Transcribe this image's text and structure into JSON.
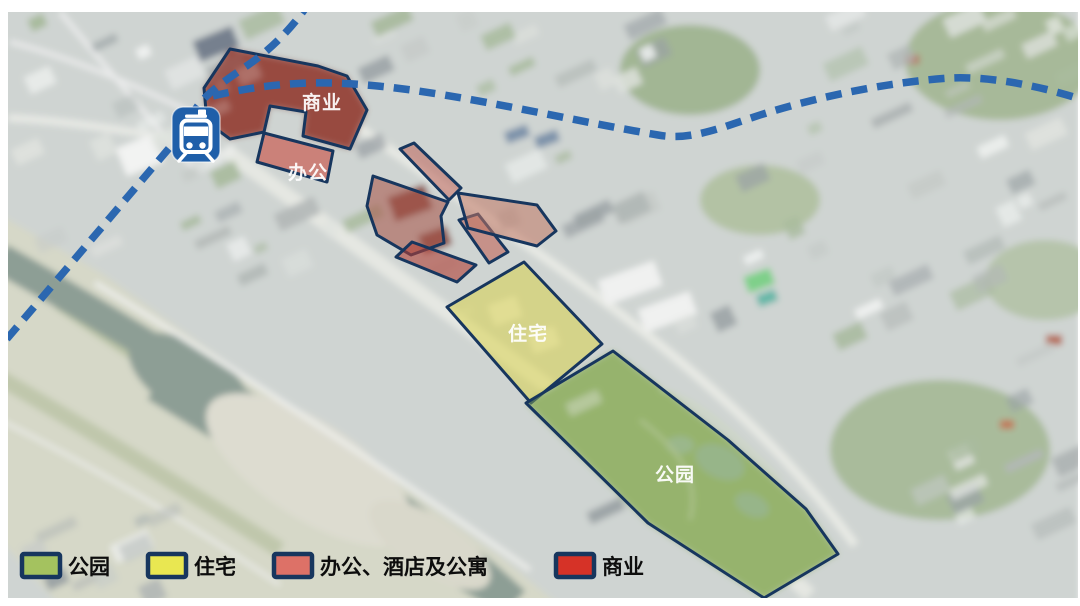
{
  "legend": {
    "swatch_border_color": "#17365e",
    "items": [
      {
        "id": "park",
        "label": "公园",
        "color": "#a4c25f"
      },
      {
        "id": "residential",
        "label": "住宅",
        "color": "#e9e751"
      },
      {
        "id": "office-hotel-apartment",
        "label": "办公、酒店及公寓",
        "color": "#dd7167"
      },
      {
        "id": "commercial",
        "label": "商业",
        "color": "#d63227"
      }
    ]
  },
  "map": {
    "zone_labels": {
      "commercial": "商业",
      "office": "办公",
      "residential": "住宅",
      "park": "公园"
    },
    "zone_fills": {
      "commercial": "#993a31",
      "office": "#c8493d",
      "mixed_sliver": "#bd6357",
      "mixed_west": "#a85a4e",
      "mixed_south": "#b03f35",
      "mixed_mid": "#c05a4c",
      "mixed_east": "#c17663",
      "residential": "#d9d23f",
      "park": "#8fb05a"
    },
    "zone_border_color": "#17365e",
    "railway": {
      "color": "#2b67b0",
      "style": "dashed"
    },
    "station": {
      "color": "#1f5fa9"
    }
  }
}
